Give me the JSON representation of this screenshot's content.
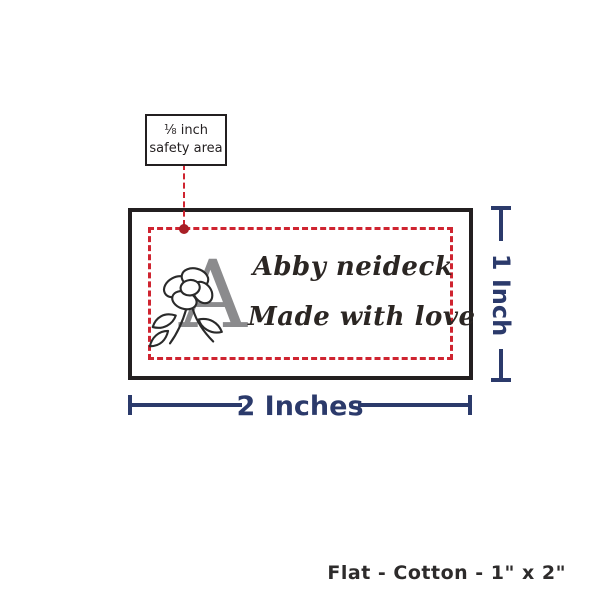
{
  "colors": {
    "accent_navy": "#2b3a6b",
    "safety_red": "#cf2430",
    "dot_red": "#a81f26",
    "outline_black": "#231f20",
    "monogram_gray": "#8b8b8d",
    "script_ink": "#2b2623",
    "footer_ink": "#2d2b2b",
    "background": "#ffffff"
  },
  "callout": {
    "line1": "⅛ inch",
    "line2": "safety area"
  },
  "label_preview": {
    "monogram_letter": "A",
    "text_line1": "Abby neideck",
    "text_line2": "Made with love"
  },
  "dimensions": {
    "width_label": "2 Inches",
    "height_label": "1 Inch"
  },
  "footer": {
    "caption": "Flat - Cotton - 1\" x 2\""
  }
}
